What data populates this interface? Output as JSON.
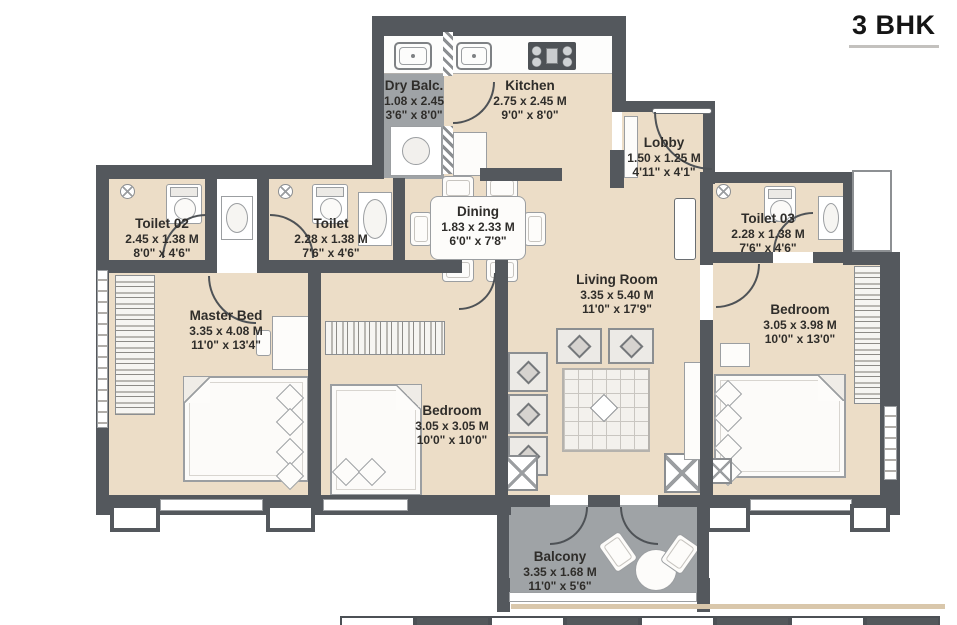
{
  "title": "3 BHK",
  "rooms": {
    "dry_balc": {
      "name": "Dry Balc.",
      "metric": "1.08 x 2.45",
      "imperial": "3'6\" x 8'0\""
    },
    "kitchen": {
      "name": "Kitchen",
      "metric": "2.75 x 2.45 M",
      "imperial": "9'0\" x 8'0\""
    },
    "lobby": {
      "name": "Lobby",
      "metric": "1.50 x 1.25 M",
      "imperial": "4'11\" x 4'1\""
    },
    "toilet_02": {
      "name": "Toilet 02",
      "metric": "2.45 x 1.38 M",
      "imperial": "8'0\" x 4'6\""
    },
    "toilet": {
      "name": "Toilet",
      "metric": "2.28 x 1.38 M",
      "imperial": "7'6\" x 4'6\""
    },
    "toilet_03": {
      "name": "Toilet 03",
      "metric": "2.28 x 1.38 M",
      "imperial": "7'6\" x 4'6\""
    },
    "dining": {
      "name": "Dining",
      "metric": "1.83 x 2.33 M",
      "imperial": "6'0\" x 7'8\""
    },
    "living_room": {
      "name": "Living Room",
      "metric": "3.35 x 5.40 M",
      "imperial": "11'0\" x 17'9\""
    },
    "master_bed": {
      "name": "Master Bed",
      "metric": "3.35 x 4.08 M",
      "imperial": "11'0\" x 13'4\""
    },
    "bedroom_mid": {
      "name": "Bedroom",
      "metric": "3.05 x 3.05 M",
      "imperial": "10'0\" x 10'0\""
    },
    "bedroom_right": {
      "name": "Bedroom",
      "metric": "3.05 x 3.98 M",
      "imperial": "10'0\" x 13'0\""
    },
    "balcony": {
      "name": "Balcony",
      "metric": "3.35 x 1.68 M",
      "imperial": "11'0\" x 5'6\""
    }
  },
  "colors": {
    "wall": "#54585d",
    "floor": "#ecddc7",
    "deck": "#9fa3a6",
    "text": "#2f2d2a"
  }
}
